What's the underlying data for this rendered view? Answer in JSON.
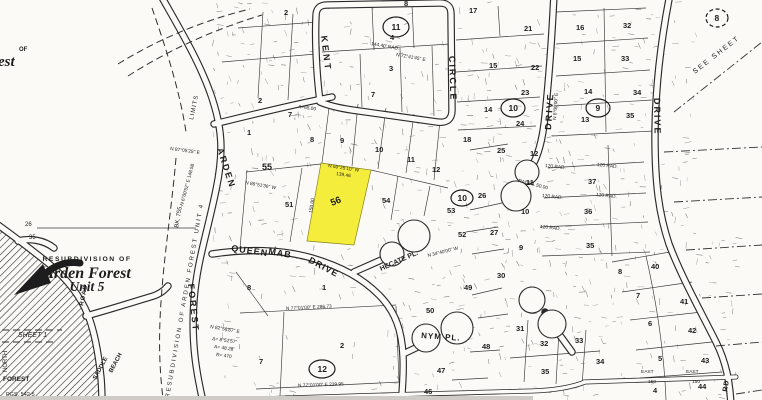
{
  "colors": {
    "paper": "#fbfaf7",
    "ink": "#1d1d1d",
    "annotation": "#3a3a3a",
    "highlight": "#f2ea22",
    "scan_strip": "#cfccc7"
  },
  "title_block": {
    "kicker": "RESUBDIVISION OF",
    "line1": "Arden Forest",
    "line2": "Unit 5"
  },
  "corner_fragment": {
    "line1": "OF",
    "line2": "est"
  },
  "highlight_parcel": {
    "lot_number": "56",
    "color": "#f2ea22"
  },
  "street_labels": [
    {
      "t": "KENT",
      "x": 321,
      "y": 36,
      "r": 83,
      "s": 9,
      "ls": 3
    },
    {
      "t": "CIRCLE",
      "x": 449,
      "y": 56,
      "r": 88,
      "s": 9,
      "ls": 2
    },
    {
      "t": "DRIVE",
      "x": 551,
      "y": 130,
      "r": -86,
      "s": 9,
      "ls": 2
    },
    {
      "t": "DRIVE",
      "x": 654,
      "y": 98,
      "r": 89,
      "s": 9,
      "ls": 2
    },
    {
      "t": "ARDEN",
      "x": 217,
      "y": 149,
      "r": 72,
      "s": 9,
      "ls": 2
    },
    {
      "t": "FOREST",
      "x": 188,
      "y": 284,
      "r": 84,
      "s": 9,
      "ls": 2
    },
    {
      "t": "QUEEN",
      "x": 231,
      "y": 251,
      "r": 8,
      "s": 9,
      "ls": 1
    },
    {
      "t": "MAB",
      "x": 268,
      "y": 254,
      "r": 10,
      "s": 9,
      "ls": 1
    },
    {
      "t": "DRIVE",
      "x": 308,
      "y": 262,
      "r": 28,
      "s": 9,
      "ls": 1
    },
    {
      "t": "HECATE PL.",
      "x": 381,
      "y": 271,
      "r": -24,
      "s": 7,
      "ls": 0
    },
    {
      "t": "NYM PL.",
      "x": 421,
      "y": 338,
      "r": 4,
      "s": 8,
      "ls": 1
    },
    {
      "t": "ROAD",
      "x": 83,
      "y": 306,
      "r": -78,
      "s": 6,
      "ls": 1
    },
    {
      "t": "SADDLE",
      "x": 96,
      "y": 380,
      "r": -62,
      "s": 6,
      "ls": 0
    },
    {
      "t": "BEACH",
      "x": 112,
      "y": 373,
      "r": -62,
      "s": 6,
      "ls": 0
    },
    {
      "t": "RD",
      "x": 727,
      "y": 392,
      "r": -80,
      "s": 7,
      "ls": 1
    }
  ],
  "lot_numbers": [
    {
      "t": "2",
      "x": 258,
      "y": 103
    },
    {
      "t": "7",
      "x": 288,
      "y": 117
    },
    {
      "t": "1",
      "x": 247,
      "y": 135
    },
    {
      "t": "2",
      "x": 284,
      "y": 15
    },
    {
      "t": "8",
      "x": 404,
      "y": 6
    },
    {
      "t": "17",
      "x": 469,
      "y": 13
    },
    {
      "t": "4",
      "x": 390,
      "y": 40
    },
    {
      "t": "3",
      "x": 389,
      "y": 71
    },
    {
      "t": "7",
      "x": 371,
      "y": 97
    },
    {
      "t": "15",
      "x": 489,
      "y": 68
    },
    {
      "t": "14",
      "x": 484,
      "y": 112
    },
    {
      "t": "18",
      "x": 463,
      "y": 142
    },
    {
      "t": "25",
      "x": 497,
      "y": 153
    },
    {
      "t": "24",
      "x": 516,
      "y": 126
    },
    {
      "t": "21",
      "x": 524,
      "y": 31
    },
    {
      "t": "22",
      "x": 531,
      "y": 70
    },
    {
      "t": "23",
      "x": 521,
      "y": 95
    },
    {
      "t": "16",
      "x": 576,
      "y": 30
    },
    {
      "t": "15",
      "x": 573,
      "y": 61
    },
    {
      "t": "14",
      "x": 584,
      "y": 94
    },
    {
      "t": "13",
      "x": 581,
      "y": 122
    },
    {
      "t": "32",
      "x": 623,
      "y": 28
    },
    {
      "t": "33",
      "x": 621,
      "y": 61
    },
    {
      "t": "34",
      "x": 633,
      "y": 95
    },
    {
      "t": "35",
      "x": 626,
      "y": 118
    },
    {
      "t": "12",
      "x": 530,
      "y": 156
    },
    {
      "t": "11",
      "x": 526,
      "y": 185
    },
    {
      "t": "10",
      "x": 521,
      "y": 214
    },
    {
      "t": "9",
      "x": 519,
      "y": 250
    },
    {
      "t": "37",
      "x": 588,
      "y": 184
    },
    {
      "t": "36",
      "x": 584,
      "y": 214
    },
    {
      "t": "35",
      "x": 586,
      "y": 248
    },
    {
      "t": "8",
      "x": 618,
      "y": 274
    },
    {
      "t": "40",
      "x": 651,
      "y": 269
    },
    {
      "t": "7",
      "x": 636,
      "y": 298
    },
    {
      "t": "41",
      "x": 680,
      "y": 304
    },
    {
      "t": "6",
      "x": 648,
      "y": 326
    },
    {
      "t": "42",
      "x": 688,
      "y": 333
    },
    {
      "t": "5",
      "x": 658,
      "y": 361
    },
    {
      "t": "43",
      "x": 701,
      "y": 363
    },
    {
      "t": "4",
      "x": 653,
      "y": 393
    },
    {
      "t": "44",
      "x": 698,
      "y": 389
    },
    {
      "t": "31",
      "x": 516,
      "y": 331
    },
    {
      "t": "32",
      "x": 540,
      "y": 346
    },
    {
      "t": "33",
      "x": 575,
      "y": 343
    },
    {
      "t": "34",
      "x": 596,
      "y": 364
    },
    {
      "t": "35",
      "x": 541,
      "y": 374
    },
    {
      "t": "8",
      "x": 247,
      "y": 290
    },
    {
      "t": "1",
      "x": 322,
      "y": 290
    },
    {
      "t": "2",
      "x": 340,
      "y": 348
    },
    {
      "t": "7",
      "x": 259,
      "y": 364
    },
    {
      "t": "50",
      "x": 426,
      "y": 313
    },
    {
      "t": "49",
      "x": 464,
      "y": 290
    },
    {
      "t": "48",
      "x": 482,
      "y": 349
    },
    {
      "t": "47",
      "x": 437,
      "y": 373
    },
    {
      "t": "46",
      "x": 424,
      "y": 394
    },
    {
      "t": "30",
      "x": 497,
      "y": 278
    },
    {
      "t": "8",
      "x": 310,
      "y": 142
    },
    {
      "t": "9",
      "x": 340,
      "y": 143
    },
    {
      "t": "10",
      "x": 375,
      "y": 152
    },
    {
      "t": "11",
      "x": 407,
      "y": 162
    },
    {
      "t": "12",
      "x": 432,
      "y": 172
    },
    {
      "t": "55",
      "x": 262,
      "y": 170,
      "s": 9
    },
    {
      "t": "51",
      "x": 285,
      "y": 207
    },
    {
      "t": "54",
      "x": 382,
      "y": 203
    },
    {
      "t": "53",
      "x": 447,
      "y": 213
    },
    {
      "t": "52",
      "x": 458,
      "y": 237
    },
    {
      "t": "26",
      "x": 478,
      "y": 198
    },
    {
      "t": "27",
      "x": 490,
      "y": 235
    }
  ],
  "circled_numbers": [
    {
      "t": "11",
      "x": 396,
      "y": 27,
      "rx": 13,
      "ry": 10
    },
    {
      "t": "8",
      "x": 717,
      "y": 18,
      "rx": 11,
      "ry": 9,
      "dashed": true
    },
    {
      "t": "10",
      "x": 513,
      "y": 108,
      "rx": 12,
      "ry": 9
    },
    {
      "t": "9",
      "x": 598,
      "y": 108,
      "rx": 12,
      "ry": 9
    },
    {
      "t": "10",
      "x": 462,
      "y": 198,
      "rx": 11,
      "ry": 8
    },
    {
      "t": "12",
      "x": 322,
      "y": 369,
      "rx": 13,
      "ry": 9
    }
  ],
  "margin_notes": [
    {
      "t": "SHEET 1",
      "x": 18,
      "y": 337,
      "s": 7,
      "i": true
    },
    {
      "t": "NORTH",
      "x": 7,
      "y": 372,
      "r": -90,
      "s": 6
    },
    {
      "t": "FOREST",
      "x": 3,
      "y": 381,
      "s": 6.5,
      "b": true
    },
    {
      "t": "PGS. 542-5",
      "x": 6,
      "y": 396,
      "s": 5.5
    },
    {
      "t": "26",
      "x": 25,
      "y": 226,
      "s": 6
    },
    {
      "t": "35",
      "x": 29,
      "y": 239,
      "s": 6
    },
    {
      "t": "LIMITS",
      "x": 193,
      "y": 120,
      "r": -78,
      "s": 6,
      "ls": 1
    },
    {
      "t": "RESUBDIVISION  OF  ARDEN  FOREST  UNIT  4",
      "x": 169,
      "y": 398,
      "r": -80,
      "s": 6,
      "ls": 2
    },
    {
      "t": "BK. 755.",
      "x": 178,
      "y": 228,
      "r": -80,
      "s": 6
    },
    {
      "t": "SEE  SHEET",
      "x": 695,
      "y": 74,
      "r": -38,
      "s": 7,
      "ls": 2
    }
  ],
  "bearing_annotations": [
    {
      "t": "N 60°25'10\" W",
      "x": 328,
      "y": 167,
      "r": 9
    },
    {
      "t": "139.46",
      "x": 336,
      "y": 175,
      "r": 9
    },
    {
      "t": "150.00",
      "x": 312,
      "y": 213,
      "r": -81
    },
    {
      "t": "N 86°51'36\" W",
      "x": 245,
      "y": 184,
      "r": 10
    },
    {
      "t": "N 77°01'00\" E   286.73",
      "x": 286,
      "y": 310,
      "r": -3
    },
    {
      "t": "N 77°01'00\" E   229.95",
      "x": 298,
      "y": 387,
      "r": -2
    },
    {
      "t": "N 34°40'00\" W",
      "x": 428,
      "y": 257,
      "r": -14
    },
    {
      "t": "120 RAD.",
      "x": 545,
      "y": 167,
      "r": 6
    },
    {
      "t": "120 RAD.",
      "x": 597,
      "y": 166,
      "r": 6
    },
    {
      "t": "120 RAD.",
      "x": 542,
      "y": 197,
      "r": 6
    },
    {
      "t": "120 RAD.",
      "x": 596,
      "y": 196,
      "r": 6
    },
    {
      "t": "120 RAD.",
      "x": 540,
      "y": 228,
      "r": 6
    },
    {
      "t": "N 8°00'00\" E",
      "x": 556,
      "y": 120,
      "r": -86
    },
    {
      "t": "RADIAL 50.00",
      "x": 518,
      "y": 182,
      "r": 14
    },
    {
      "t": "A=65.00",
      "x": 298,
      "y": 108,
      "r": 8
    },
    {
      "t": "144.40' RAD.",
      "x": 371,
      "y": 45,
      "r": 10
    },
    {
      "t": "N 77°41'45\" E",
      "x": 396,
      "y": 56,
      "r": 10
    },
    {
      "t": "N 87°05'25\" E",
      "x": 170,
      "y": 150,
      "r": 8
    },
    {
      "t": "N 6°00'52\" E  148.58",
      "x": 183,
      "y": 206,
      "r": -75
    },
    {
      "t": "N 82°56'57\" E",
      "x": 210,
      "y": 328,
      "r": 10
    },
    {
      "t": "Δ= 8°52'57\"",
      "x": 212,
      "y": 340,
      "r": 8
    },
    {
      "t": "A= 48.28",
      "x": 214,
      "y": 348,
      "r": 8
    },
    {
      "t": "R= 470",
      "x": 216,
      "y": 356,
      "r": 8
    },
    {
      "t": "EAST",
      "x": 641,
      "y": 373
    },
    {
      "t": "EAST",
      "x": 686,
      "y": 373
    },
    {
      "t": "150",
      "x": 648,
      "y": 383
    },
    {
      "t": "150",
      "x": 692,
      "y": 383
    }
  ]
}
